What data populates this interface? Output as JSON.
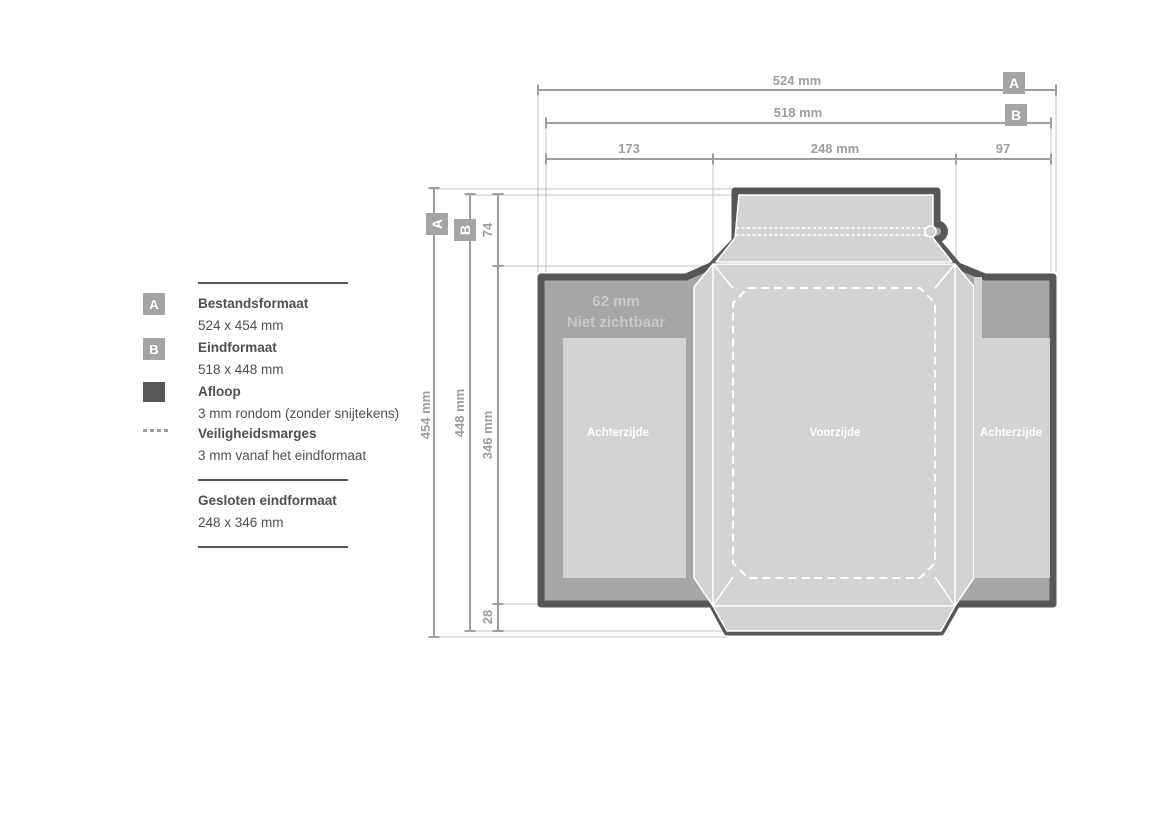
{
  "colors": {
    "c-dark": "#57575a",
    "c-medium": "#a6a6a7",
    "c-light": "#d3d3d4",
    "c-dim": "#9e9ea0",
    "c-badge": "#a4a4a6",
    "c-thin": "#c6c6c7",
    "c-note": "#c8c8c9",
    "c-text": "#505053",
    "c-white": "#ffffff"
  },
  "badges": {
    "a": "A",
    "b": "B"
  },
  "legend": {
    "items": [
      {
        "badge": "A",
        "title": "Bestandsformaat",
        "value": "524 x 454 mm"
      },
      {
        "badge": "B",
        "title": "Eindformaat",
        "value": "518 x 448 mm"
      },
      {
        "swatch": "afloop",
        "title": "Afloop",
        "value": "3 mm rondom (zonder snijtekens)"
      },
      {
        "swatch": "dotted",
        "title": "Veiligheidsmarges",
        "value": "3 mm vanaf het eindformaat"
      }
    ],
    "closed": {
      "title": "Gesloten eindformaat",
      "value": "248 x 346 mm"
    }
  },
  "dimensions": {
    "top": {
      "a": "524 mm",
      "b": "518 mm",
      "segments": [
        "173",
        "248 mm",
        "97"
      ]
    },
    "left": {
      "a": "454 mm",
      "b": "448 mm",
      "segments": [
        "74",
        "346 mm",
        "28"
      ]
    }
  },
  "panels": {
    "left": "Achterzijde",
    "front": "Voorzijde",
    "right": "Achterzijde",
    "note_line1": "62 mm",
    "note_line2": "Niet zichtbaar"
  }
}
